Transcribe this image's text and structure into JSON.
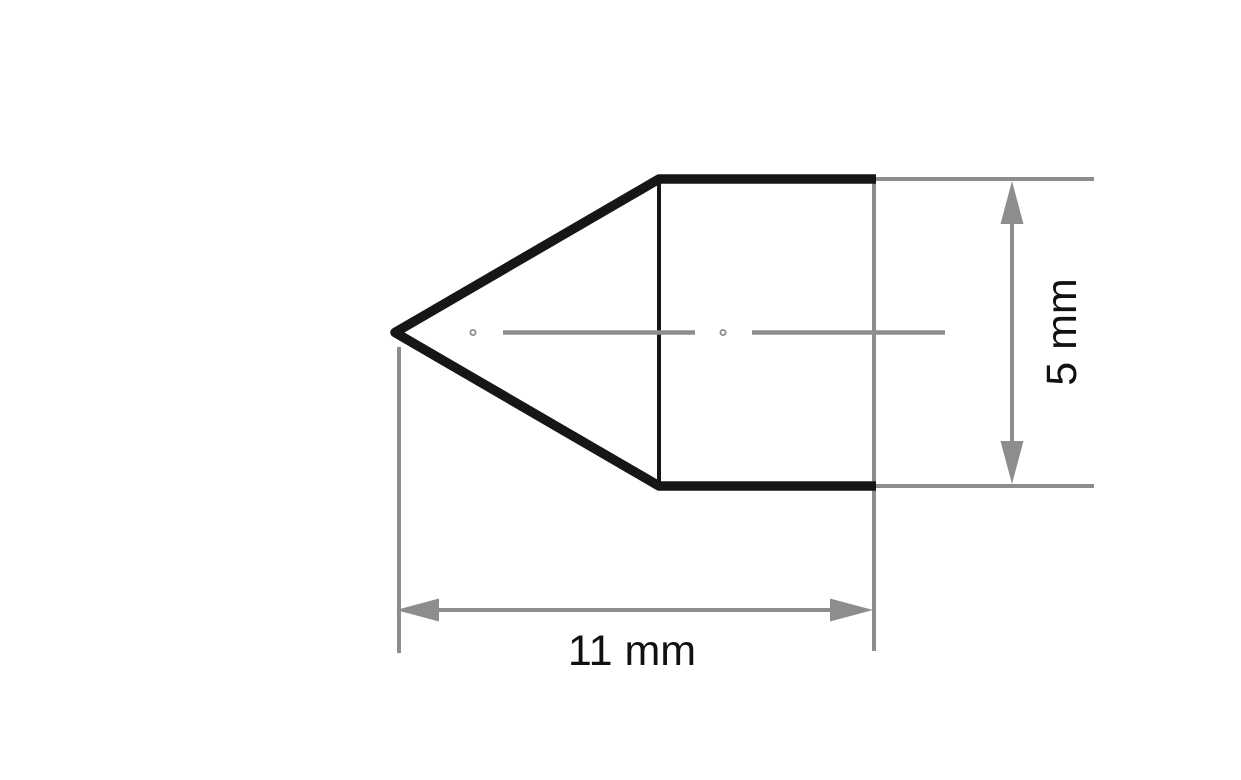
{
  "colors": {
    "outline": "#161616",
    "dimension": "#8d8d8d",
    "label": "#111111",
    "background": "#ffffff"
  },
  "labels": {
    "length": "11 mm",
    "diameter": "5 mm"
  },
  "dimensions": {
    "length_value": 11,
    "diameter_value": 5,
    "unit": "mm"
  }
}
